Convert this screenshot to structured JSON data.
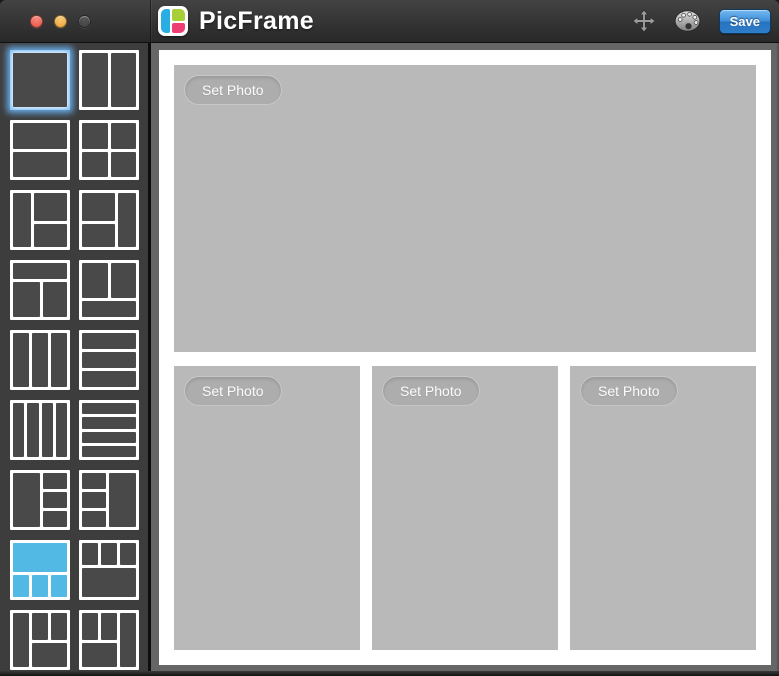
{
  "titlebar": {
    "app_title": "PicFrame",
    "save_label": "Save",
    "traffic_lights": [
      {
        "name": "close",
        "color_top": "#f9897e",
        "color_bottom": "#e4503f"
      },
      {
        "name": "minimize",
        "color_top": "#f7ca72",
        "color_bottom": "#eb9f36"
      },
      {
        "name": "zoom",
        "color_top": "#555555",
        "color_bottom": "#3f3f3f",
        "disabled": true
      }
    ],
    "icons": [
      "move-icon",
      "palette-icon"
    ]
  },
  "logo": {
    "left_color": "#29aee4",
    "top_right_color": "#a8cf38",
    "bottom_right_color": "#ee3d72"
  },
  "colors": {
    "accent_selected": "#52b8e4",
    "focus_glow": "#69b4f5",
    "thumbnail_cell": "#494949",
    "sidebar_bg": "#3d3d3d",
    "main_bg": "#666666",
    "placeholder": "#b9b9b9",
    "save_button_blue": "#2e7dc9"
  },
  "sidebar": {
    "thumbnails": [
      {
        "id": "single",
        "focused": true,
        "selected": false,
        "layout": {
          "cols": "1fr",
          "rows": "1fr",
          "cells": [
            {}
          ]
        }
      },
      {
        "id": "two-columns",
        "selected": false,
        "layout": {
          "cols": "1fr 1fr",
          "rows": "1fr",
          "cells": [
            {},
            {}
          ]
        }
      },
      {
        "id": "two-rows",
        "selected": false,
        "layout": {
          "cols": "1fr",
          "rows": "1fr 1fr",
          "cells": [
            {},
            {}
          ]
        }
      },
      {
        "id": "grid-2x2",
        "selected": false,
        "layout": {
          "cols": "1fr 1fr",
          "rows": "1fr 1fr",
          "cells": [
            {},
            {},
            {},
            {}
          ]
        }
      },
      {
        "id": "left-column-right-two-rows",
        "selected": false,
        "layout": {
          "cols": "1fr 1.9fr",
          "rows": "1.2fr 1fr",
          "cells": [
            {
              "c": "1",
              "r": "1 / 3"
            },
            {
              "c": "2",
              "r": "1"
            },
            {
              "c": "2",
              "r": "2"
            }
          ]
        }
      },
      {
        "id": "left-two-rows-right-column",
        "selected": false,
        "layout": {
          "cols": "1.9fr 1fr",
          "rows": "1.2fr 1fr",
          "cells": [
            {
              "c": "1",
              "r": "1"
            },
            {
              "c": "1",
              "r": "2"
            },
            {
              "c": "2",
              "r": "1 / 3"
            }
          ]
        }
      },
      {
        "id": "top-bar-bottom-two-columns",
        "selected": false,
        "layout": {
          "cols": "1.1fr 1fr",
          "rows": "1fr 2.2fr",
          "cells": [
            {
              "c": "1 / 3",
              "r": "1"
            },
            {
              "c": "1",
              "r": "2"
            },
            {
              "c": "2",
              "r": "2"
            }
          ]
        }
      },
      {
        "id": "top-two-columns-bottom-bar",
        "selected": false,
        "layout": {
          "cols": "1fr 1fr",
          "rows": "2.2fr 1fr",
          "cells": [
            {
              "c": "1",
              "r": "1"
            },
            {
              "c": "2",
              "r": "1"
            },
            {
              "c": "1 / 3",
              "r": "2"
            }
          ]
        }
      },
      {
        "id": "three-columns",
        "selected": false,
        "layout": {
          "cols": "1fr 1fr 1fr",
          "rows": "1fr",
          "cells": [
            {},
            {},
            {}
          ]
        }
      },
      {
        "id": "three-rows",
        "selected": false,
        "layout": {
          "cols": "1fr",
          "rows": "1fr 1fr 1fr",
          "cells": [
            {},
            {},
            {}
          ]
        }
      },
      {
        "id": "four-columns",
        "selected": false,
        "layout": {
          "cols": "1fr 1fr 1fr 1fr",
          "rows": "1fr",
          "cells": [
            {},
            {},
            {},
            {}
          ]
        }
      },
      {
        "id": "four-rows",
        "selected": false,
        "layout": {
          "cols": "1fr",
          "rows": "1fr 1fr 1fr 1fr",
          "cells": [
            {},
            {},
            {},
            {}
          ]
        }
      },
      {
        "id": "left-panel-right-three-rows",
        "selected": false,
        "layout": {
          "cols": "1.15fr 1fr",
          "rows": "1fr 1fr 1fr",
          "cells": [
            {
              "c": "1",
              "r": "1 / 4"
            },
            {
              "c": "2",
              "r": "1"
            },
            {
              "c": "2",
              "r": "2"
            },
            {
              "c": "2",
              "r": "3"
            }
          ]
        }
      },
      {
        "id": "left-three-rows-right-panel",
        "selected": false,
        "layout": {
          "cols": "1fr 1.15fr",
          "rows": "1fr 1fr 1fr",
          "cells": [
            {
              "c": "1",
              "r": "1"
            },
            {
              "c": "1",
              "r": "2"
            },
            {
              "c": "1",
              "r": "3"
            },
            {
              "c": "2",
              "r": "1 / 4"
            }
          ]
        }
      },
      {
        "id": "top-panel-bottom-three-columns",
        "selected": true,
        "layout": {
          "cols": "1fr 1fr 1fr",
          "rows": "1.3fr 1fr",
          "cells": [
            {
              "c": "1 / 4",
              "r": "1"
            },
            {
              "c": "1",
              "r": "2"
            },
            {
              "c": "2",
              "r": "2"
            },
            {
              "c": "3",
              "r": "2"
            }
          ]
        }
      },
      {
        "id": "top-three-columns-bottom-panel",
        "selected": false,
        "layout": {
          "cols": "1fr 1fr 1fr",
          "rows": "1fr 1.3fr",
          "cells": [
            {
              "c": "1",
              "r": "1"
            },
            {
              "c": "2",
              "r": "1"
            },
            {
              "c": "3",
              "r": "1"
            },
            {
              "c": "1 / 4",
              "r": "2"
            }
          ]
        }
      },
      {
        "id": "left-column-top-pair-bottom-bar",
        "selected": false,
        "layout": {
          "cols": "1fr 1fr 1fr",
          "rows": "1.15fr 1fr",
          "cells": [
            {
              "c": "1",
              "r": "1 / 3"
            },
            {
              "c": "2",
              "r": "1"
            },
            {
              "c": "3",
              "r": "1"
            },
            {
              "c": "2 / 4",
              "r": "2"
            }
          ]
        }
      },
      {
        "id": "top-pair-right-column-bottom-bar",
        "selected": false,
        "layout": {
          "cols": "1fr 1fr 1fr",
          "rows": "1.15fr 1fr",
          "cells": [
            {
              "c": "1",
              "r": "1"
            },
            {
              "c": "2",
              "r": "1"
            },
            {
              "c": "3",
              "r": "1 / 3"
            },
            {
              "c": "1 / 3",
              "r": "2"
            }
          ]
        }
      }
    ]
  },
  "canvas": {
    "set_photo_label": "Set Photo",
    "placeholders": [
      "top-wide",
      "bottom-left",
      "bottom-center",
      "bottom-right"
    ]
  }
}
